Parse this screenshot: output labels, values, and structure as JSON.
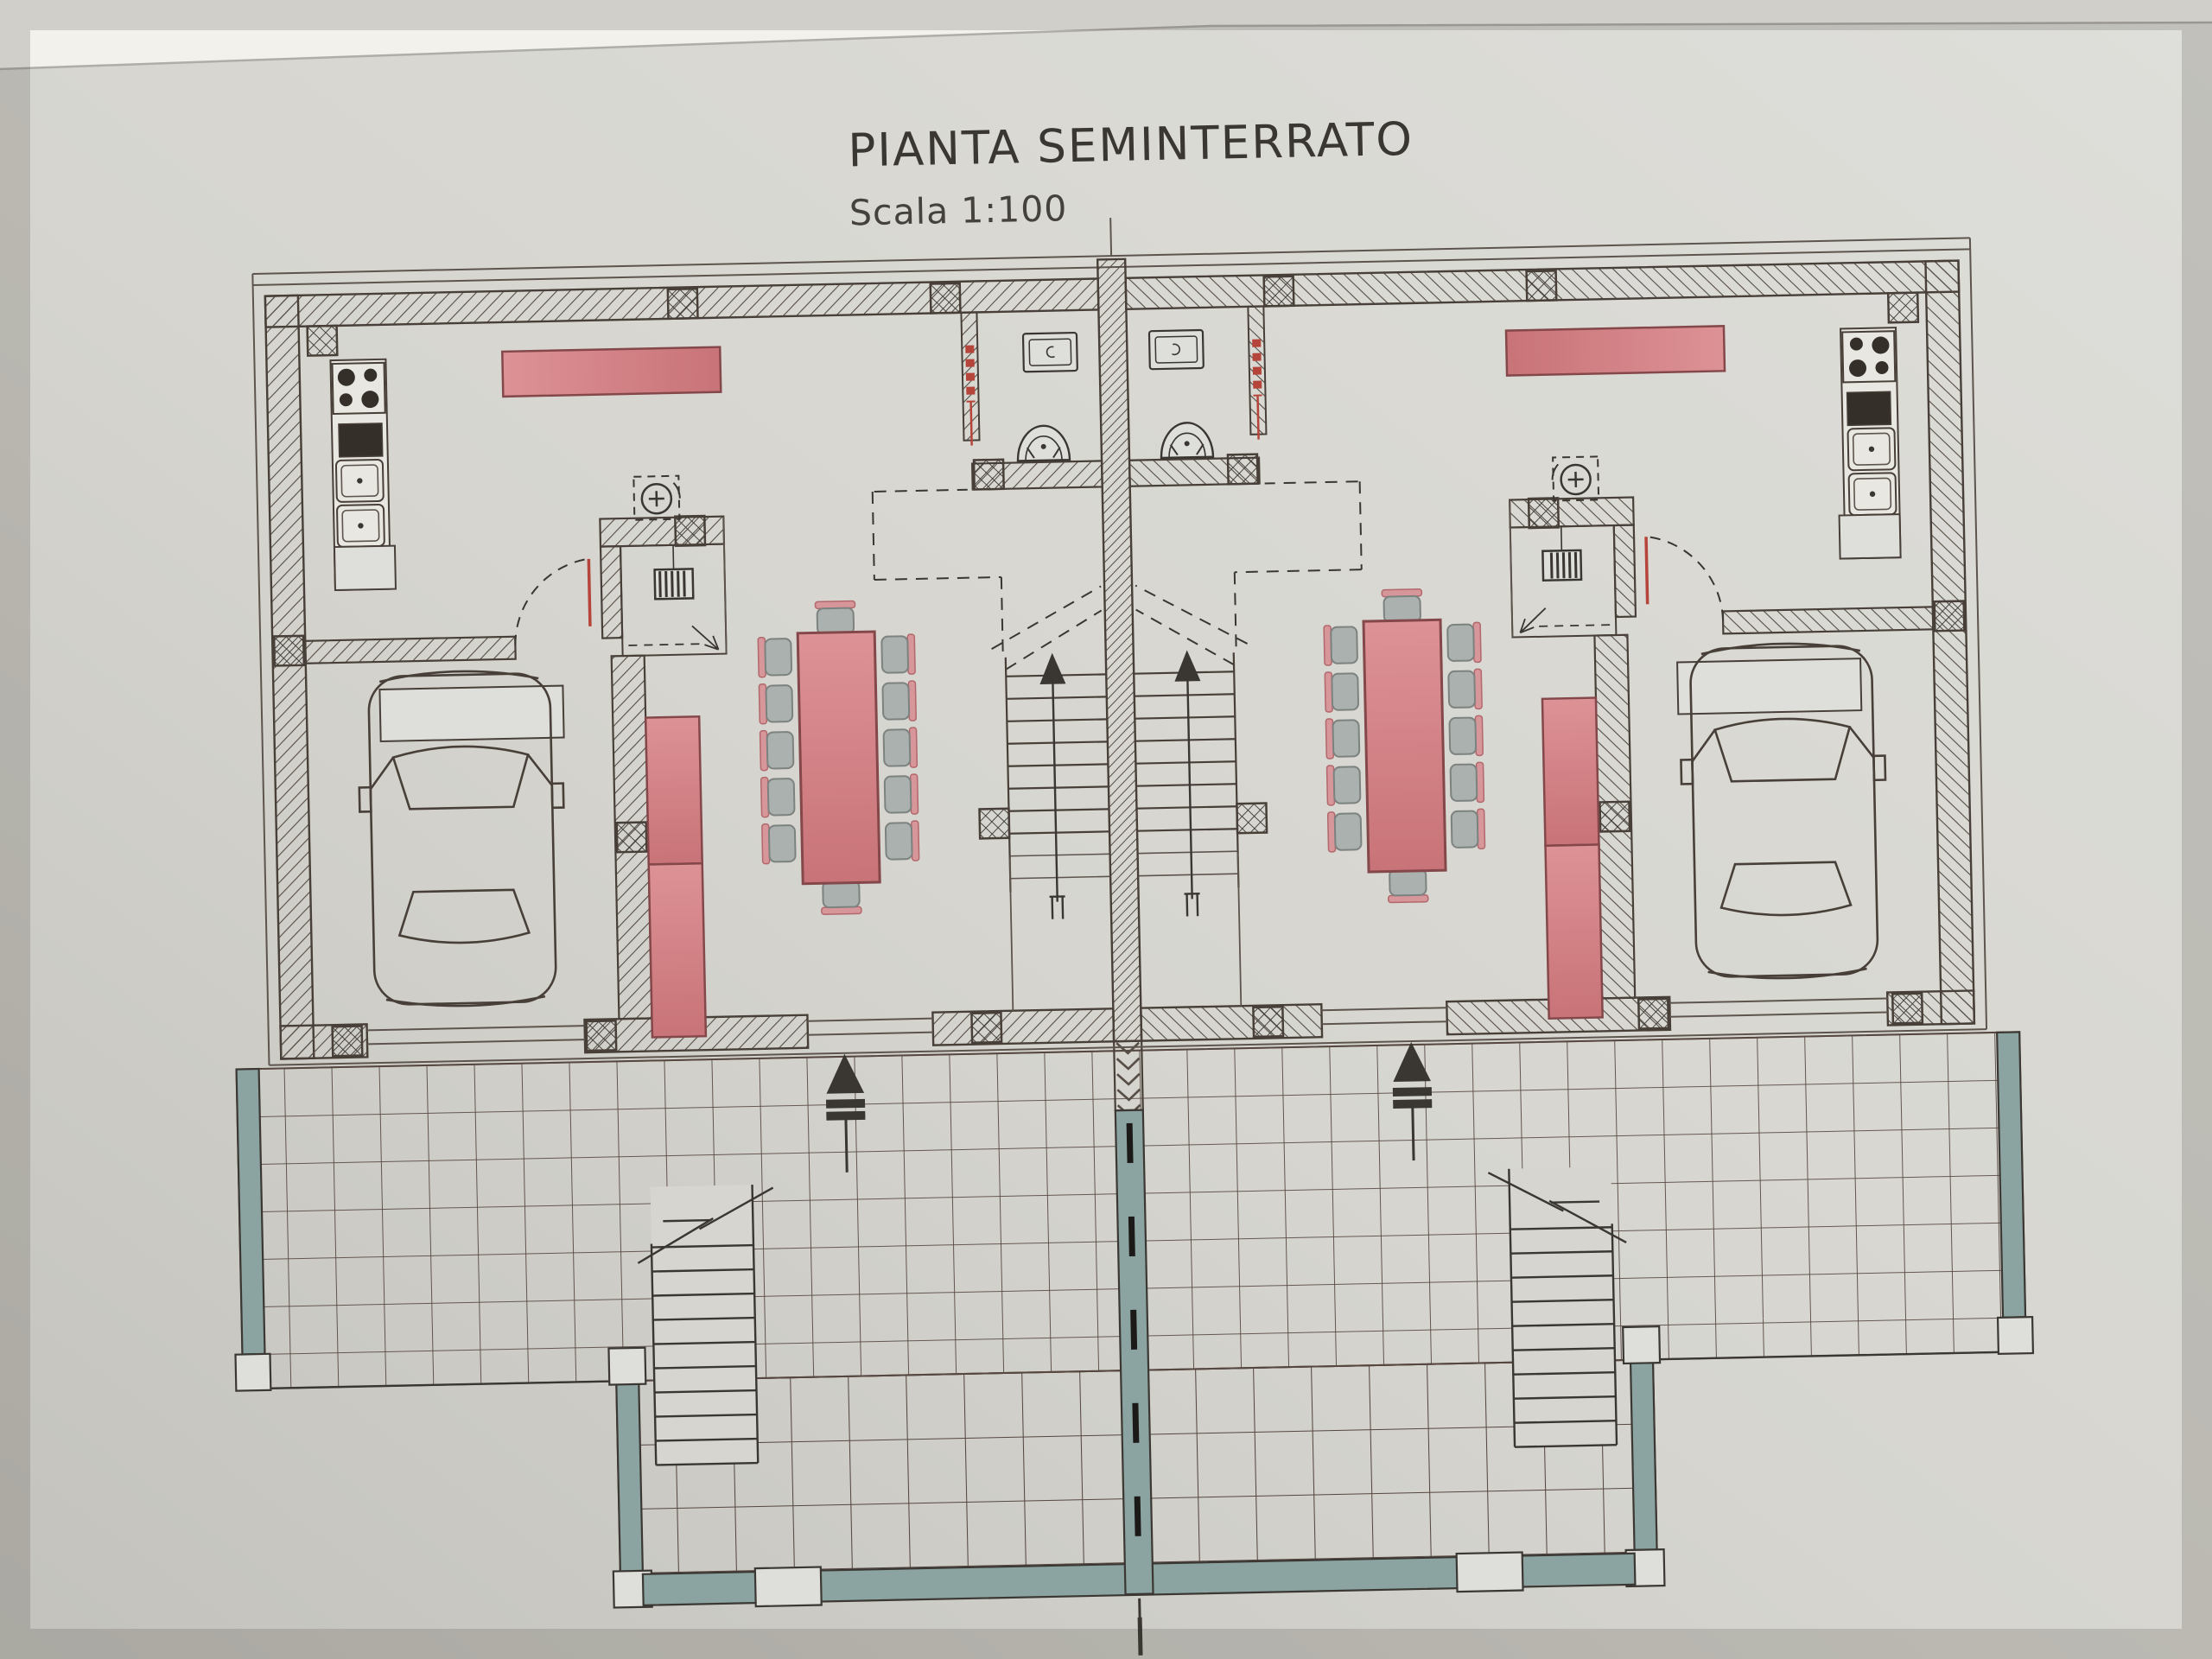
{
  "header": {
    "title": "PIANTA SEMINTERRATO",
    "scale": "Scala 1:100"
  },
  "colors": {
    "paper": "#d6d5cf",
    "paper_light": "#dededa",
    "paper_dark": "#c3c2bc",
    "band": "#f2f1ec",
    "band_edge": "#aeada7",
    "ink": "#3a3631",
    "ink2": "#45413c",
    "line": "#473f38",
    "thin": "#5d554d",
    "hatchline": "#554c44",
    "tile": "#564740",
    "red_fill": "#dd9296",
    "red_fill2": "#c87377",
    "red_edge": "#84474a",
    "pipe_red": "#b5443a",
    "chair": "#abb1af",
    "chair_edge": "#7c827f",
    "chair_back": "#d6969a",
    "teal": "#8ba3a1",
    "teal_edge": "#3b3733",
    "dark_fill": "#352f2a",
    "white_fix": "#e8e7e1"
  },
  "plan_summary": {
    "residential_units": 2,
    "garages": 2,
    "cars_parked": 2,
    "dining_tables": 2,
    "chairs_per_table": 12,
    "bathrooms": 2,
    "kitchen_corners": 2,
    "boiler_closets": 2,
    "internal_stair_flights": 2,
    "external_stair_flights": 2,
    "entrance_arrows": 2
  }
}
